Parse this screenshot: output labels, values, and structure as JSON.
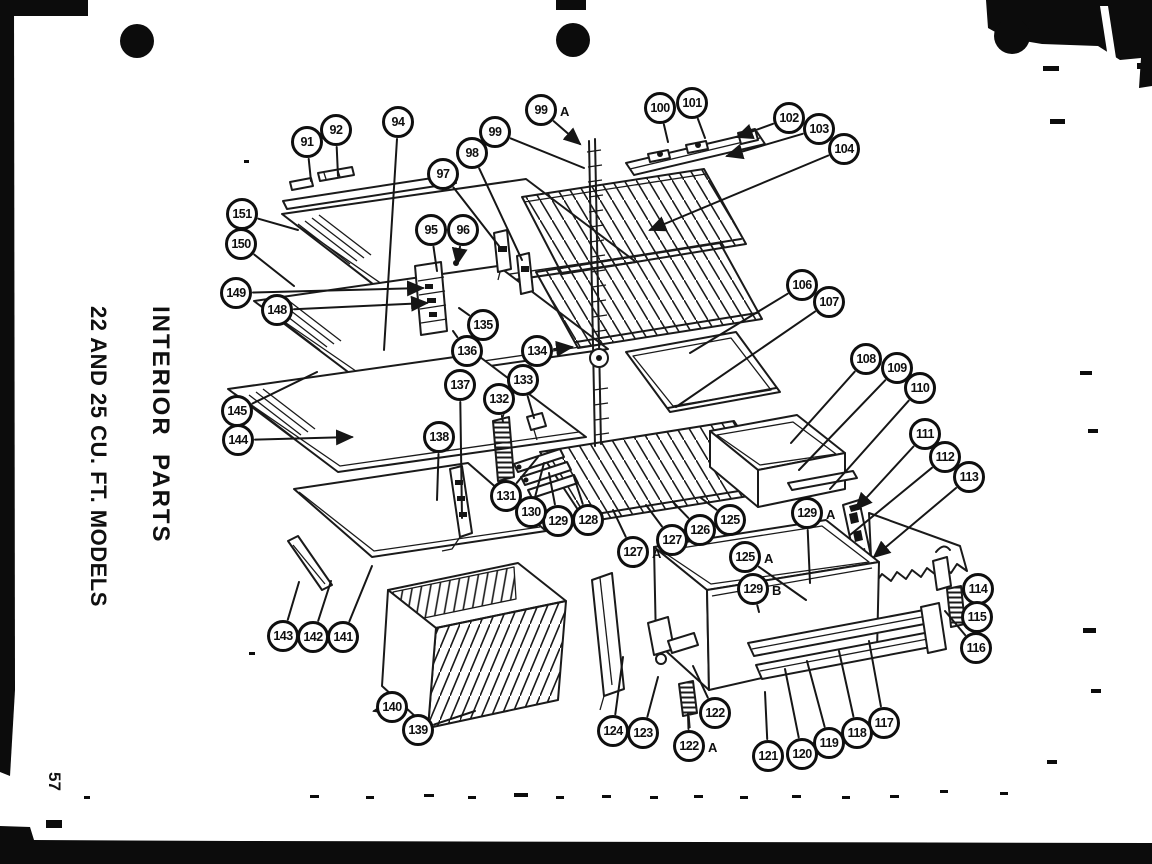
{
  "page": {
    "side_title_line1": "INTERIOR  PARTS",
    "side_title_line2": "22 AND 25 CU. FT. MODELS",
    "page_number": "57"
  },
  "colors": {
    "paper": "#ffffff",
    "ink": "#1a1a1a"
  },
  "diagram": {
    "callouts": [
      {
        "label": "91",
        "x": 307,
        "y": 142,
        "tx": 311,
        "ty": 181
      },
      {
        "label": "92",
        "x": 336,
        "y": 130,
        "tx": 338,
        "ty": 176
      },
      {
        "label": "94",
        "x": 398,
        "y": 122,
        "tx": 384,
        "ty": 350
      },
      {
        "label": "95",
        "x": 431,
        "y": 230,
        "tx": 437,
        "ty": 271
      },
      {
        "label": "96",
        "x": 463,
        "y": 230,
        "tx": 457,
        "ty": 264,
        "arrow": true
      },
      {
        "label": "97",
        "x": 443,
        "y": 174,
        "tx": 499,
        "ty": 246
      },
      {
        "label": "98",
        "x": 472,
        "y": 153,
        "tx": 522,
        "ty": 260
      },
      {
        "label": "99",
        "x": 495,
        "y": 132,
        "tx": 584,
        "ty": 168
      },
      {
        "label": "99",
        "suffix": "A",
        "x": 541,
        "y": 110,
        "tx": 580,
        "ty": 144,
        "arrow": true
      },
      {
        "label": "100",
        "x": 660,
        "y": 108,
        "tx": 668,
        "ty": 142
      },
      {
        "label": "101",
        "x": 692,
        "y": 103,
        "tx": 705,
        "ty": 138
      },
      {
        "label": "102",
        "x": 789,
        "y": 118,
        "tx": 737,
        "ty": 137,
        "arrow": true
      },
      {
        "label": "103",
        "x": 819,
        "y": 129,
        "tx": 727,
        "ty": 156,
        "arrow": true
      },
      {
        "label": "104",
        "x": 844,
        "y": 149,
        "tx": 650,
        "ty": 230,
        "arrow": true
      },
      {
        "label": "106",
        "x": 802,
        "y": 285,
        "tx": 690,
        "ty": 353
      },
      {
        "label": "107",
        "x": 829,
        "y": 302,
        "tx": 676,
        "ty": 407
      },
      {
        "label": "108",
        "x": 866,
        "y": 359,
        "tx": 791,
        "ty": 443
      },
      {
        "label": "109",
        "x": 897,
        "y": 368,
        "tx": 799,
        "ty": 470
      },
      {
        "label": "110",
        "x": 920,
        "y": 388,
        "tx": 830,
        "ty": 489
      },
      {
        "label": "111",
        "x": 925,
        "y": 434,
        "tx": 856,
        "ty": 509,
        "arrow": true
      },
      {
        "label": "112",
        "x": 945,
        "y": 457,
        "tx": 850,
        "ty": 535
      },
      {
        "label": "113",
        "x": 969,
        "y": 477,
        "tx": 874,
        "ty": 557,
        "arrow": true
      },
      {
        "label": "114",
        "x": 978,
        "y": 589,
        "tx": 963,
        "ty": 594
      },
      {
        "label": "115",
        "x": 977,
        "y": 617,
        "tx": 961,
        "ty": 616
      },
      {
        "label": "116",
        "x": 976,
        "y": 648,
        "tx": 945,
        "ty": 611
      },
      {
        "label": "117",
        "x": 884,
        "y": 723,
        "tx": 869,
        "ty": 641
      },
      {
        "label": "118",
        "x": 857,
        "y": 733,
        "tx": 839,
        "ty": 651
      },
      {
        "label": "119",
        "x": 829,
        "y": 743,
        "tx": 807,
        "ty": 661
      },
      {
        "label": "120",
        "x": 802,
        "y": 754,
        "tx": 785,
        "ty": 669
      },
      {
        "label": "121",
        "x": 768,
        "y": 756,
        "tx": 765,
        "ty": 692
      },
      {
        "label": "122",
        "x": 715,
        "y": 713,
        "tx": 693,
        "ty": 666
      },
      {
        "label": "122",
        "suffix": "A",
        "x": 689,
        "y": 746,
        "tx": 688,
        "ty": 714
      },
      {
        "label": "123",
        "x": 643,
        "y": 733,
        "tx": 658,
        "ty": 677
      },
      {
        "label": "124",
        "x": 613,
        "y": 731,
        "tx": 623,
        "ty": 657
      },
      {
        "label": "125",
        "x": 730,
        "y": 520,
        "tx": 701,
        "ty": 498
      },
      {
        "label": "125",
        "suffix": "A",
        "x": 745,
        "y": 557,
        "tx": 806,
        "ty": 600
      },
      {
        "label": "126",
        "x": 700,
        "y": 530,
        "tx": 673,
        "ty": 502
      },
      {
        "label": "127",
        "x": 672,
        "y": 540,
        "tx": 646,
        "ty": 505
      },
      {
        "label": "127",
        "suffix": "A",
        "x": 633,
        "y": 552,
        "tx": 613,
        "ty": 510
      },
      {
        "label": "128",
        "x": 588,
        "y": 520,
        "tx": 574,
        "ty": 477
      },
      {
        "label": "129",
        "x": 558,
        "y": 521,
        "tx": 549,
        "ty": 473
      },
      {
        "label": "129",
        "suffix": "A",
        "x": 807,
        "y": 513,
        "tx": 810,
        "ty": 583
      },
      {
        "label": "129",
        "suffix": "B",
        "x": 753,
        "y": 589,
        "tx": 759,
        "ty": 612
      },
      {
        "label": "130",
        "x": 531,
        "y": 512,
        "tx": 544,
        "ty": 463
      },
      {
        "label": "131",
        "x": 506,
        "y": 496,
        "tx": 538,
        "ty": 457
      },
      {
        "label": "132",
        "x": 499,
        "y": 399,
        "tx": 503,
        "ty": 422
      },
      {
        "label": "133",
        "x": 523,
        "y": 380,
        "tx": 534,
        "ty": 418
      },
      {
        "label": "134",
        "x": 537,
        "y": 351,
        "tx": 572,
        "ty": 347,
        "arrow": true
      },
      {
        "label": "135",
        "x": 483,
        "y": 325,
        "tx": 459,
        "ty": 308
      },
      {
        "label": "136",
        "x": 467,
        "y": 351,
        "tx": 453,
        "ty": 331
      },
      {
        "label": "137",
        "x": 460,
        "y": 385,
        "tx": 462,
        "ty": 518
      },
      {
        "label": "138",
        "x": 439,
        "y": 437,
        "tx": 437,
        "ty": 500
      },
      {
        "label": "139",
        "x": 418,
        "y": 730,
        "tx": 475,
        "ty": 711
      },
      {
        "label": "140",
        "x": 392,
        "y": 707,
        "tx": 374,
        "ty": 711,
        "arrow": true
      },
      {
        "label": "141",
        "x": 343,
        "y": 637,
        "tx": 372,
        "ty": 566
      },
      {
        "label": "142",
        "x": 313,
        "y": 637,
        "tx": 331,
        "ty": 581
      },
      {
        "label": "143",
        "x": 283,
        "y": 636,
        "tx": 299,
        "ty": 582
      },
      {
        "label": "144",
        "x": 238,
        "y": 440,
        "tx": 352,
        "ty": 437,
        "arrow": true
      },
      {
        "label": "145",
        "x": 237,
        "y": 411,
        "tx": 317,
        "ty": 372
      },
      {
        "label": "148",
        "x": 277,
        "y": 310,
        "tx": 427,
        "ty": 303,
        "arrow": true
      },
      {
        "label": "149",
        "x": 236,
        "y": 293,
        "tx": 423,
        "ty": 288,
        "arrow": true
      },
      {
        "label": "150",
        "x": 241,
        "y": 244,
        "tx": 294,
        "ty": 286
      },
      {
        "label": "151",
        "x": 242,
        "y": 214,
        "tx": 298,
        "ty": 230
      }
    ]
  }
}
